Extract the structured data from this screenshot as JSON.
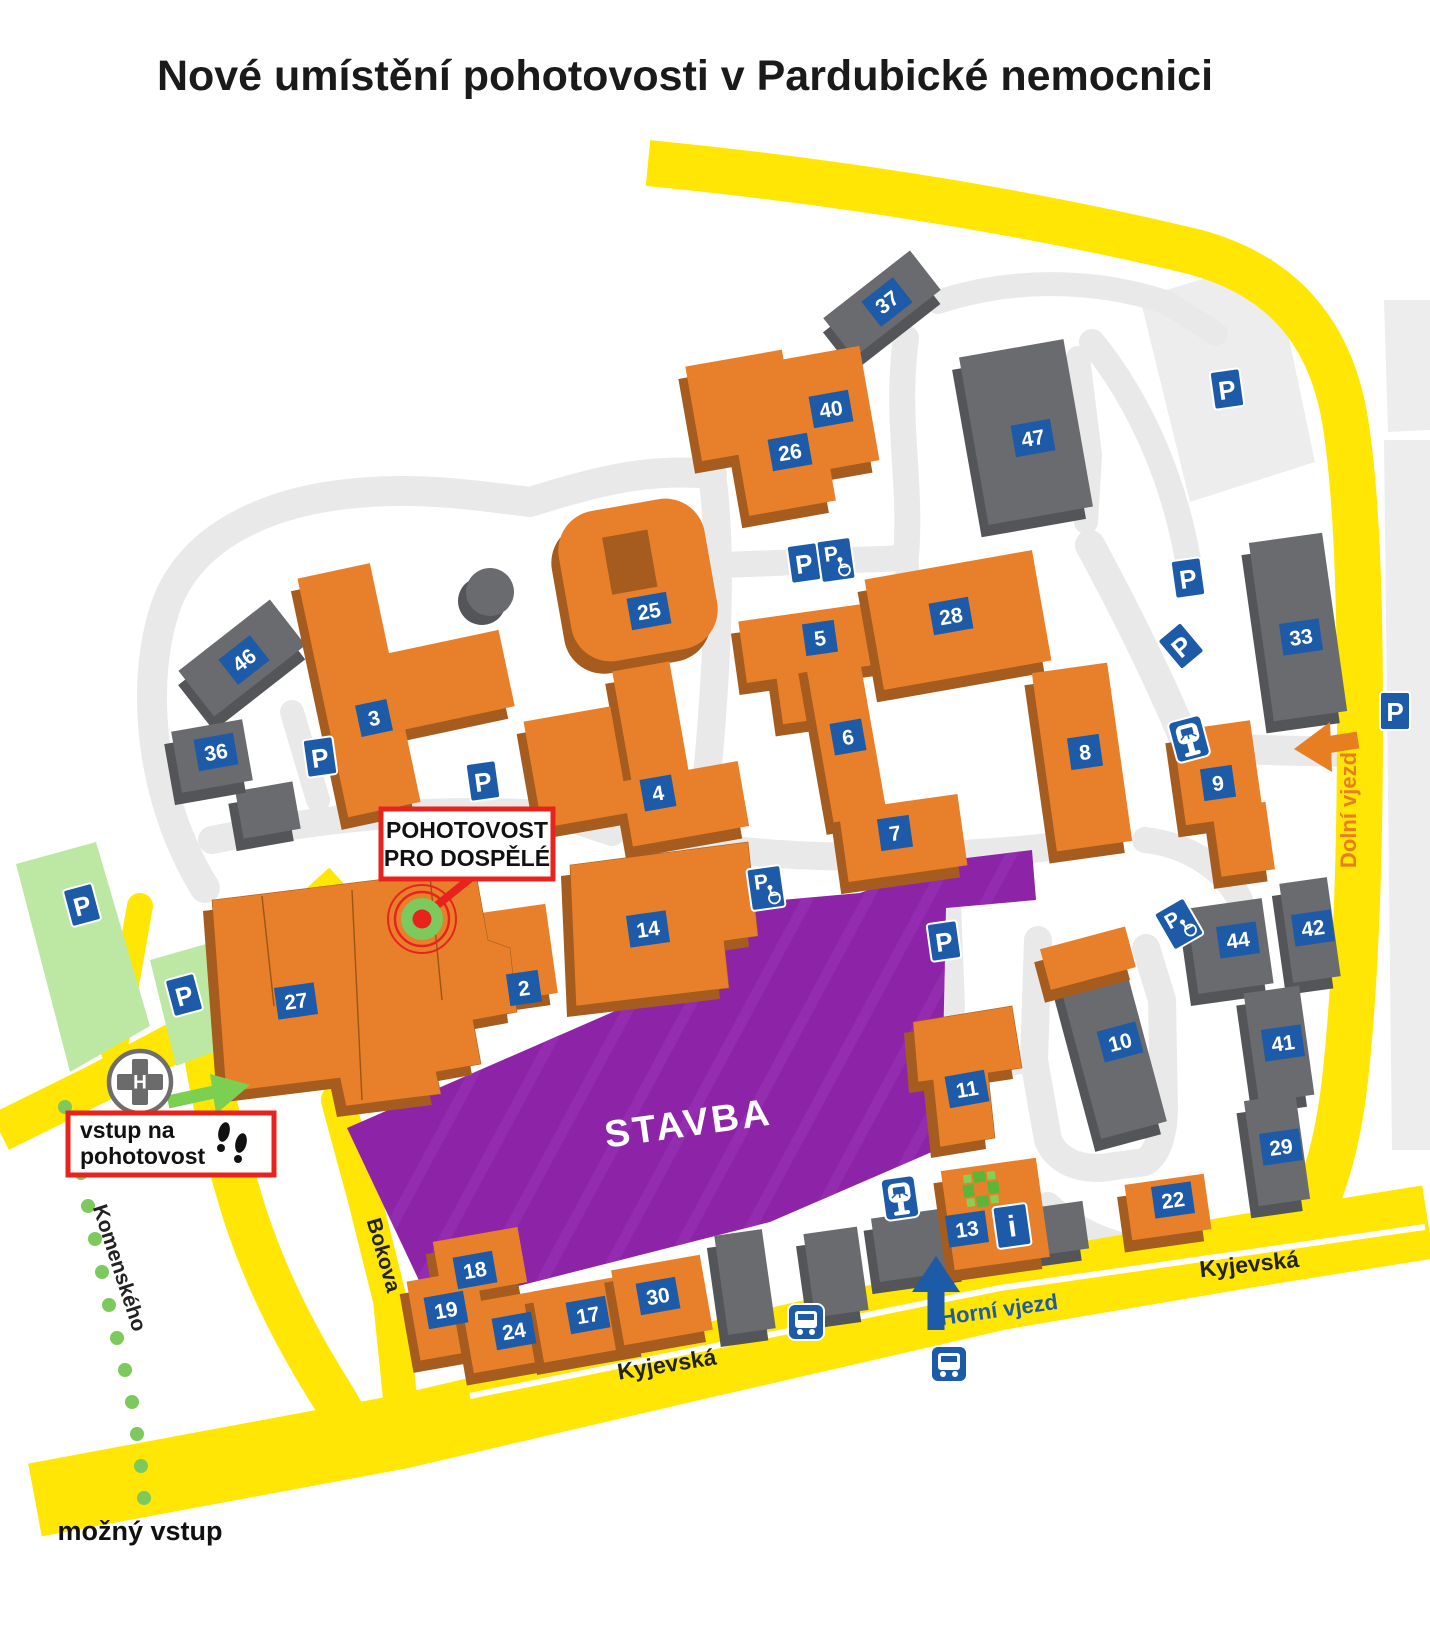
{
  "title": "Nové umístění pohotovosti v Pardubické nemocnici",
  "map": {
    "construction_label": "STAVBA",
    "callouts": {
      "emergency": {
        "line1": "POHOTOVOST",
        "line2": "PRO DOSPĚLÉ"
      },
      "entrance": {
        "line1": "vstup na",
        "line2": "pohotovost"
      },
      "possible_entrance": "možný vstup"
    },
    "streets": [
      {
        "name": "Kyjevská",
        "x": 668,
        "y": 1372,
        "rot": -9,
        "color": "#222222",
        "size": 23
      },
      {
        "name": "Kyjevská",
        "x": 1250,
        "y": 1272,
        "rot": -6,
        "color": "#222222",
        "size": 23
      },
      {
        "name": "Bokova",
        "x": 377,
        "y": 1257,
        "rot": 74,
        "color": "#222222",
        "size": 21
      },
      {
        "name": "Komenského",
        "x": 113,
        "y": 1270,
        "rot": 72,
        "color": "#222222",
        "size": 21
      },
      {
        "name": "Horní vjezd",
        "x": 1000,
        "y": 1317,
        "rot": -8,
        "color": "#1D5BA8",
        "size": 22
      },
      {
        "name": "Dolní vjezd",
        "x": 1356,
        "y": 810,
        "rot": -90,
        "color": "#E87E22",
        "size": 22
      }
    ],
    "buildings": [
      {
        "number": "37",
        "color": "gray",
        "x": 887,
        "y": 302,
        "rot": -38
      },
      {
        "number": "40",
        "color": "orange",
        "x": 831,
        "y": 409,
        "rot": -10
      },
      {
        "number": "26",
        "color": "orange",
        "x": 790,
        "y": 452,
        "rot": -10
      },
      {
        "number": "47",
        "color": "gray",
        "x": 1033,
        "y": 438,
        "rot": -10
      },
      {
        "number": "46",
        "color": "gray",
        "x": 244,
        "y": 660,
        "rot": -38
      },
      {
        "number": "36",
        "color": "gray",
        "x": 216,
        "y": 752,
        "rot": -10
      },
      {
        "number": "3",
        "color": "orange",
        "x": 374,
        "y": 718,
        "rot": -12
      },
      {
        "number": "25",
        "color": "orange",
        "x": 649,
        "y": 611,
        "rot": -10
      },
      {
        "number": "4",
        "color": "orange",
        "x": 658,
        "y": 793,
        "rot": -10
      },
      {
        "number": "5",
        "color": "orange",
        "x": 820,
        "y": 638,
        "rot": -8
      },
      {
        "number": "6",
        "color": "orange",
        "x": 848,
        "y": 737,
        "rot": -10
      },
      {
        "number": "7",
        "color": "orange",
        "x": 895,
        "y": 833,
        "rot": -8
      },
      {
        "number": "28",
        "color": "orange",
        "x": 951,
        "y": 616,
        "rot": -10
      },
      {
        "number": "8",
        "color": "orange",
        "x": 1085,
        "y": 752,
        "rot": -8
      },
      {
        "number": "9",
        "color": "orange",
        "x": 1218,
        "y": 783,
        "rot": -8
      },
      {
        "number": "33",
        "color": "gray",
        "x": 1301,
        "y": 637,
        "rot": -8
      },
      {
        "number": "14",
        "color": "orange",
        "x": 648,
        "y": 929,
        "rot": -8
      },
      {
        "number": "2",
        "color": "orange",
        "x": 524,
        "y": 988,
        "rot": -8
      },
      {
        "number": "27",
        "color": "orange",
        "x": 296,
        "y": 1001,
        "rot": -8
      },
      {
        "number": "10",
        "color": "gray",
        "x": 1120,
        "y": 1042,
        "rot": -15
      },
      {
        "number": "11",
        "color": "orange",
        "x": 967,
        "y": 1089,
        "rot": -10
      },
      {
        "number": "44",
        "color": "gray",
        "x": 1238,
        "y": 940,
        "rot": -8
      },
      {
        "number": "42",
        "color": "gray",
        "x": 1313,
        "y": 928,
        "rot": -8
      },
      {
        "number": "41",
        "color": "gray",
        "x": 1283,
        "y": 1043,
        "rot": -8
      },
      {
        "number": "29",
        "color": "gray",
        "x": 1281,
        "y": 1147,
        "rot": -8
      },
      {
        "number": "22",
        "color": "orange",
        "x": 1173,
        "y": 1200,
        "rot": -8
      },
      {
        "number": "13",
        "color": "orange",
        "x": 967,
        "y": 1229,
        "rot": -8
      },
      {
        "number": "18",
        "color": "orange",
        "x": 475,
        "y": 1270,
        "rot": -10
      },
      {
        "number": "19",
        "color": "orange",
        "x": 446,
        "y": 1310,
        "rot": -10
      },
      {
        "number": "24",
        "color": "orange",
        "x": 514,
        "y": 1331,
        "rot": -10
      },
      {
        "number": "17",
        "color": "orange",
        "x": 588,
        "y": 1315,
        "rot": -10
      },
      {
        "number": "30",
        "color": "orange",
        "x": 658,
        "y": 1296,
        "rot": -10
      }
    ],
    "icons": {
      "parking": [
        {
          "x": 82,
          "y": 905,
          "rot": -15
        },
        {
          "x": 184,
          "y": 995,
          "rot": -15
        },
        {
          "x": 320,
          "y": 757,
          "rot": -8
        },
        {
          "x": 483,
          "y": 781,
          "rot": -8
        },
        {
          "x": 804,
          "y": 563,
          "rot": -8
        },
        {
          "x": 1188,
          "y": 578,
          "rot": -8
        },
        {
          "x": 1227,
          "y": 389,
          "rot": -8
        },
        {
          "x": 1395,
          "y": 711,
          "rot": 0
        },
        {
          "x": 944,
          "y": 941,
          "rot": -8
        },
        {
          "x": 1181,
          "y": 646,
          "rot": -40
        }
      ],
      "parking_disabled": [
        {
          "x": 836,
          "y": 560,
          "rot": -8
        },
        {
          "x": 766,
          "y": 888,
          "rot": -8
        },
        {
          "x": 1179,
          "y": 924,
          "rot": -30
        }
      ],
      "parking_meter": [
        {
          "x": 1189,
          "y": 739,
          "rot": -15
        },
        {
          "x": 900,
          "y": 1198,
          "rot": -8
        }
      ],
      "bus_stop": [
        {
          "x": 806,
          "y": 1322,
          "rot": 0
        },
        {
          "x": 949,
          "y": 1364,
          "rot": 0
        }
      ],
      "info": {
        "x": 1012,
        "y": 1226,
        "rot": -8,
        "label": "i"
      },
      "hospital": {
        "x": 140,
        "y": 1082,
        "label": "H"
      },
      "pharmacy_cross": {
        "x": 981,
        "y": 1189
      }
    },
    "colors": {
      "building_orange": "#E8802B",
      "building_orange_shadow": "#A55C1E",
      "building_gray": "#6A6B6F",
      "building_gray_shadow": "#545559",
      "badge_blue": "#1D5BA8",
      "road_yellow": "#FFE605",
      "path_gray": "#E9E9E9",
      "parking_green": "#BDE8A3",
      "construction_purple": "#8D24A8",
      "accent_green": "#7CC95E",
      "accent_red": "#E8231E"
    }
  }
}
